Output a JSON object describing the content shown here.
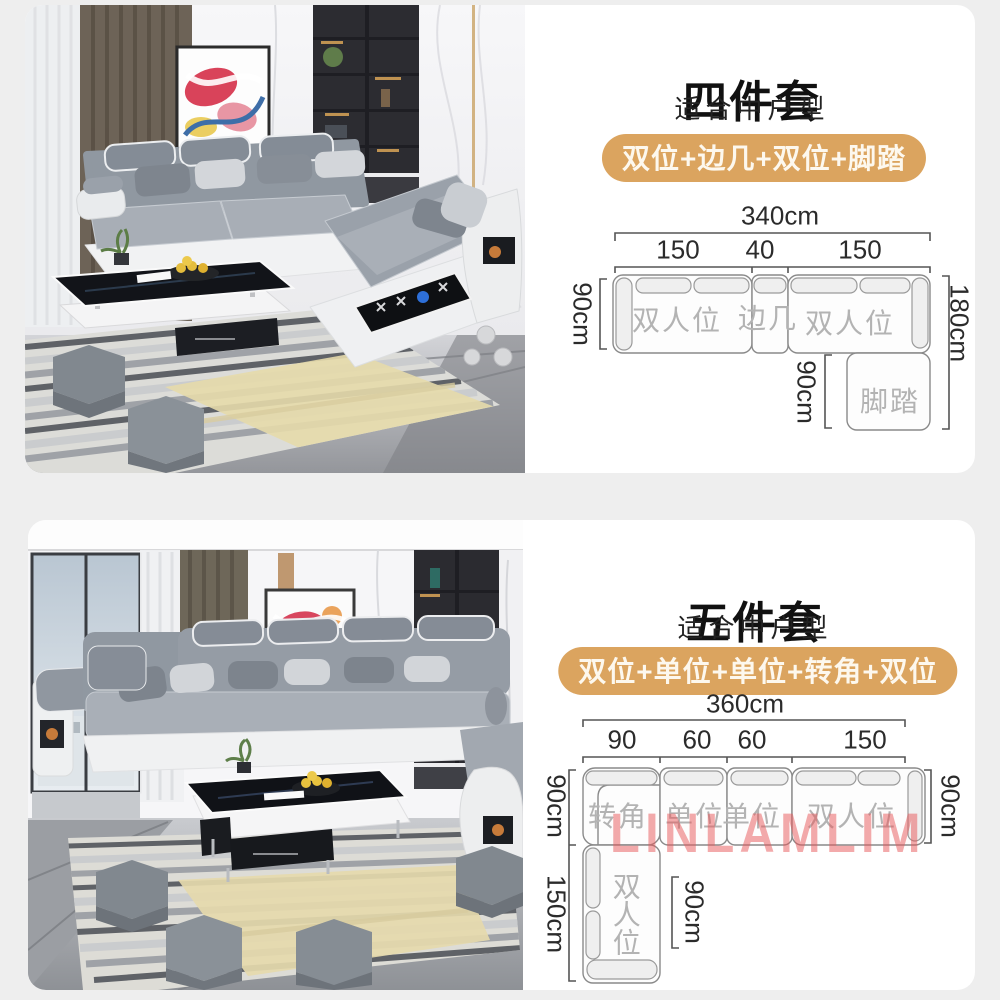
{
  "colors": {
    "page_background": "#eeeeee",
    "card_background": "#ffffff",
    "badge_background": "#dba45f",
    "badge_text": "#fdf8ee",
    "title_text": "#111111",
    "diagram_line": "#777777",
    "diagram_section_label": "#b3b3b3",
    "watermark_red": "#e85558"
  },
  "cards": [
    {
      "title": "四件套",
      "subtitle": "适合中户型",
      "badge": "双位+边几+双位+脚踏",
      "diagram": {
        "total": "340cm",
        "segments": [
          "150",
          "40",
          "150"
        ],
        "left_depth": "90cm",
        "right_span": "180cm",
        "ottoman_depth": "90cm",
        "sections": [
          "双人位",
          "边几",
          "双人位"
        ],
        "ottoman": "脚踏"
      }
    },
    {
      "title": "五件套",
      "subtitle": "适合中户型",
      "badge": "双位+单位+单位+转角+双位",
      "watermark": "LINLAMLIM",
      "diagram": {
        "total": "360cm",
        "segments": [
          "90",
          "60",
          "60",
          "150"
        ],
        "left_depth": "90cm",
        "left_chaise_length": "150cm",
        "right_depth": "90cm",
        "chaise_inner_depth": "90cm",
        "sections": [
          "转角",
          "单位",
          "单位",
          "双人位"
        ],
        "chaise": "双人位"
      }
    }
  ]
}
